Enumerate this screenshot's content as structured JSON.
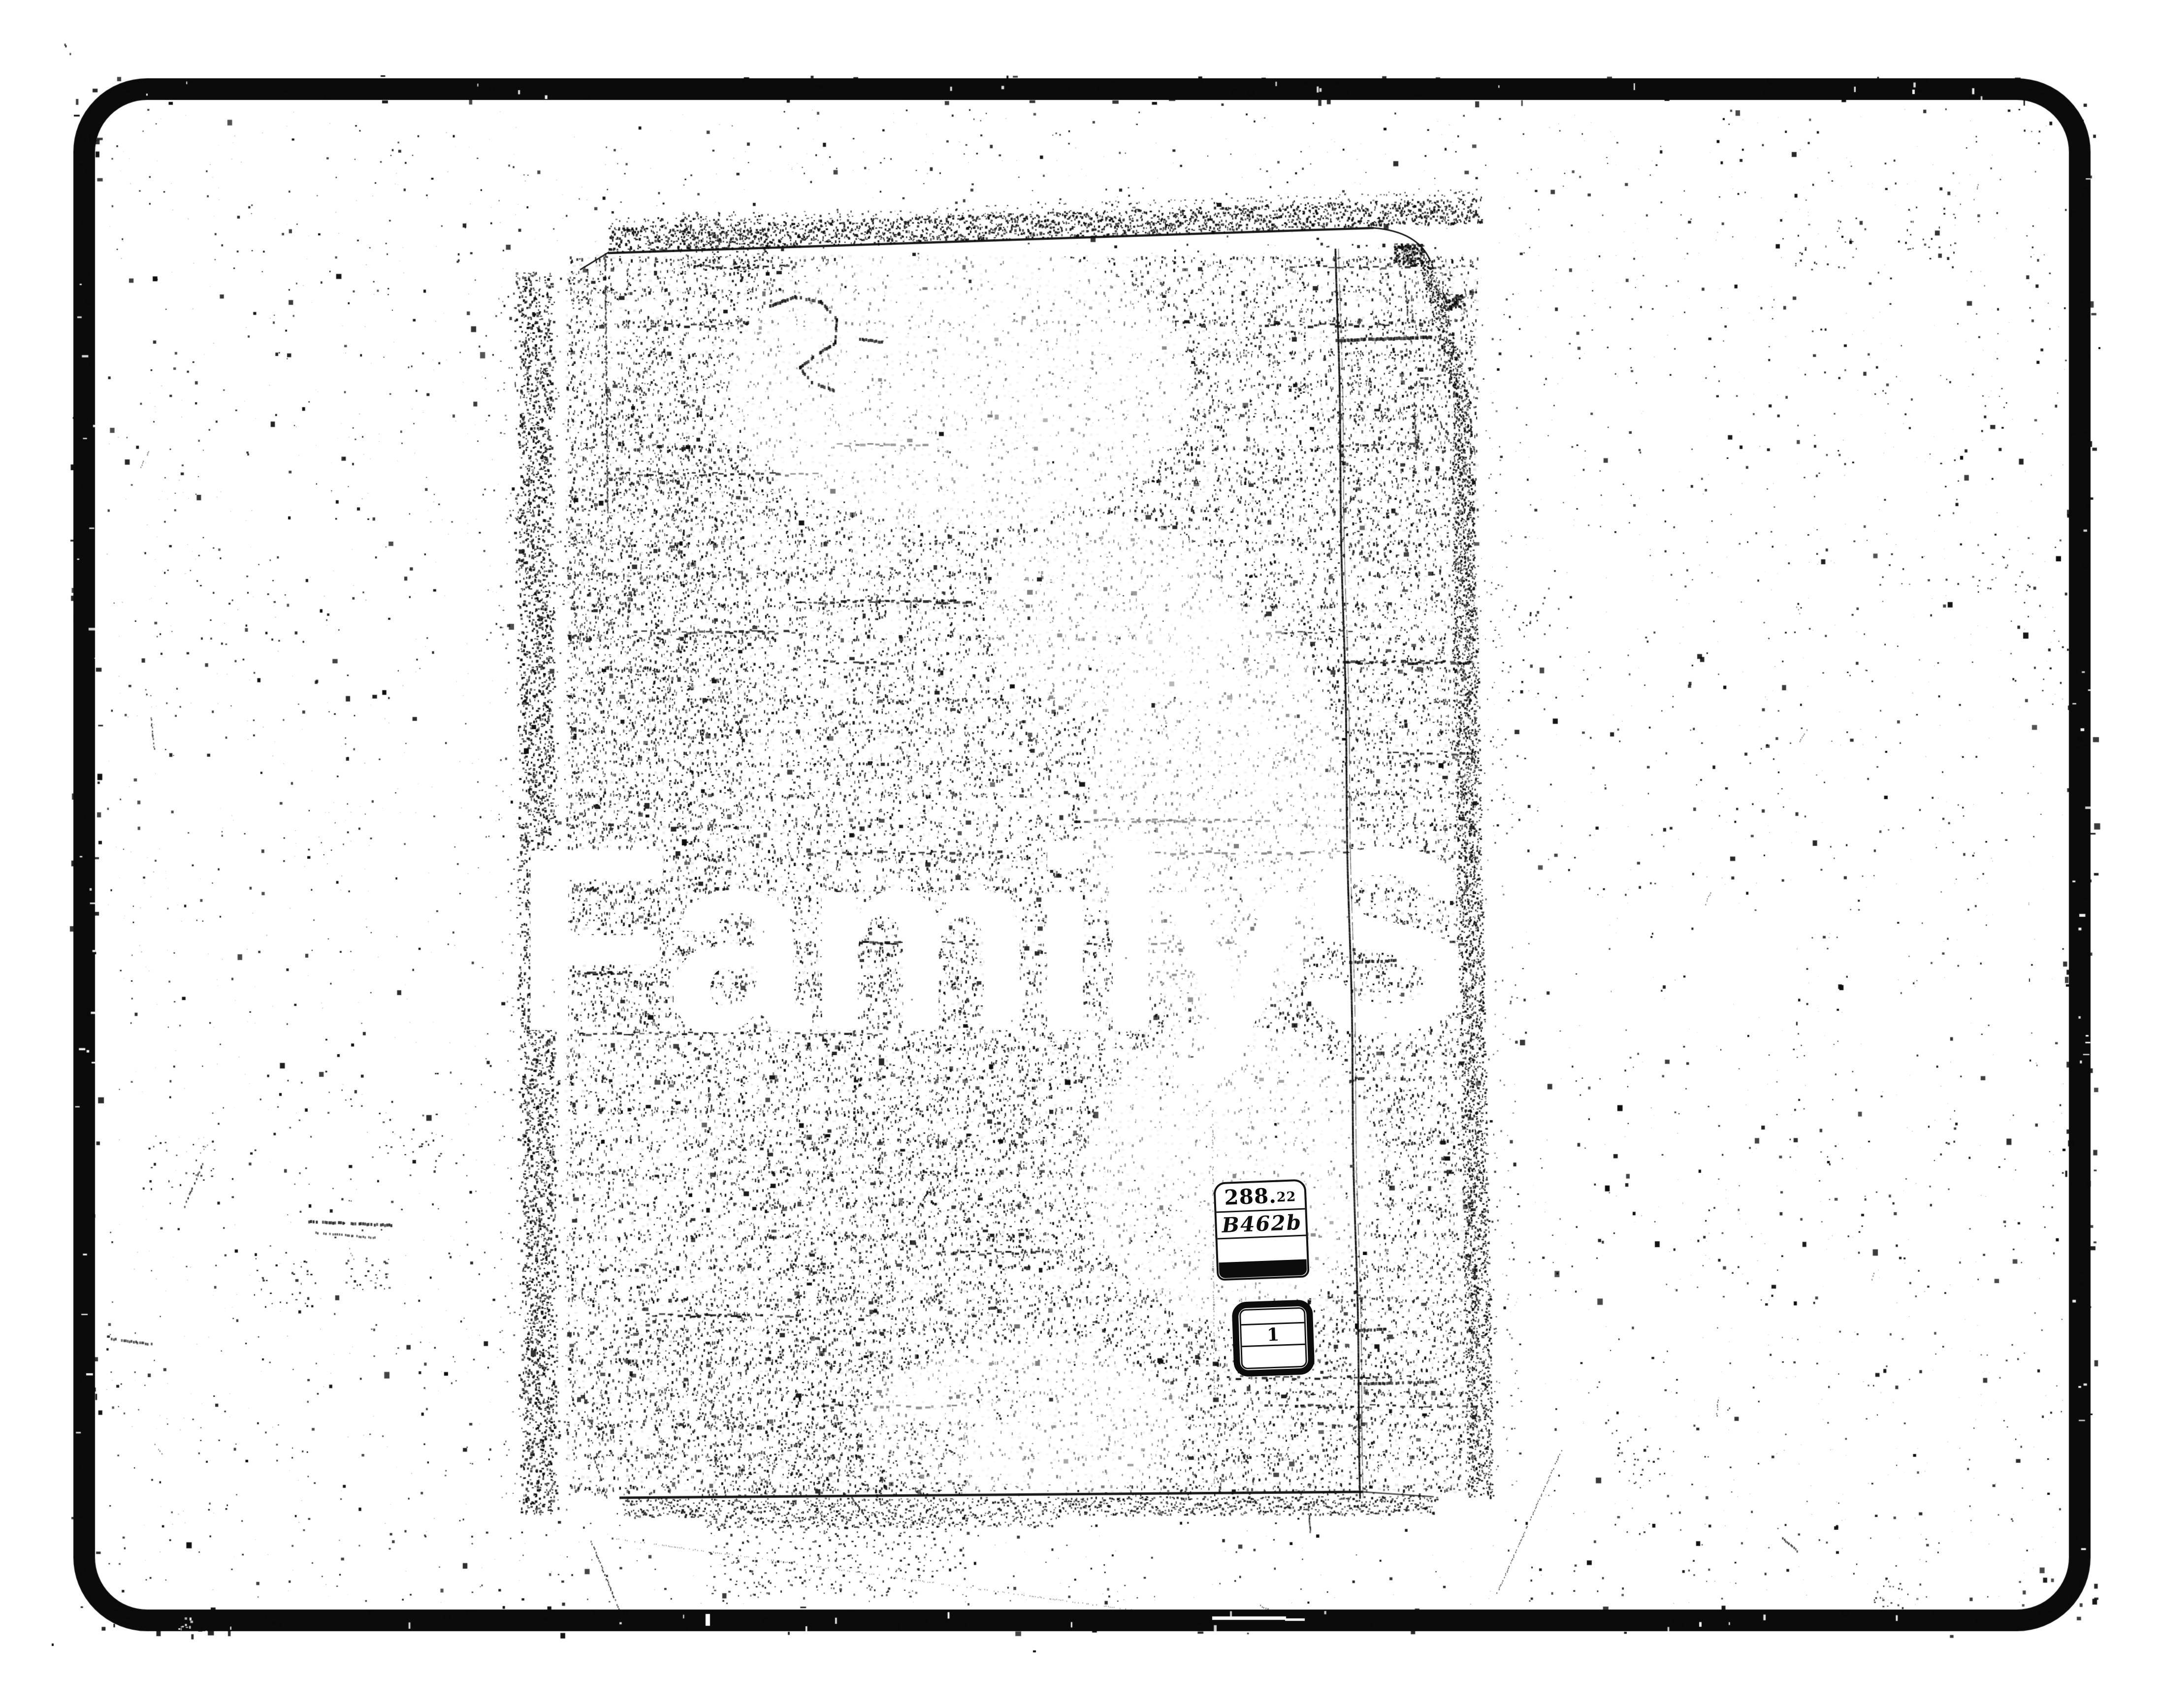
{
  "scan": {
    "paper_color": "#ffffff",
    "ink_color": "#0b0b0b",
    "watermark": {
      "text": "FamilySearch"
    },
    "call_number_label": {
      "dewey_main": "288.",
      "dewey_sub": "22",
      "cutter": "B462b"
    },
    "volume_box": {
      "value": "1"
    }
  }
}
